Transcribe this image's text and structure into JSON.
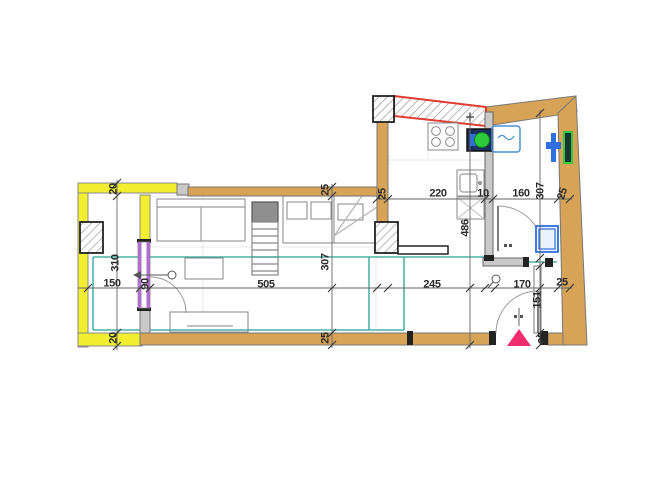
{
  "drawing": {
    "kind": "apartment floor plan",
    "units": "cm"
  },
  "dims": {
    "balcony_top": "20",
    "balcony_depth": "310",
    "balcony_width": "150",
    "balcony_door": "90",
    "balcony_bottom": "20",
    "living_width": "505",
    "living_depth": "307",
    "living_bottom": "25",
    "living_top": "25",
    "kitchen_wall": "25",
    "kitchen_width": "220",
    "partition": "10",
    "bath_width": "160",
    "bath_depth": "307",
    "right_wall": "25",
    "kitchen_depth": "486",
    "hall_width": "245",
    "entry_width": "170",
    "entry_wall": "25",
    "entry_depth": "151",
    "entry_bottom": "25"
  },
  "colors": {
    "wall_fill": "#d7a457",
    "highlight_yellow": "#f2ef30",
    "red_wall": "#e03c31",
    "door_violet": "#b06fc8",
    "floor_teal": "#2aa198",
    "fixture_blue": "#2f6fe0",
    "boiler_green": "#2ecc3a",
    "entrance_pink": "#ef2d6e",
    "wall_gray": "#c9c9c9"
  }
}
